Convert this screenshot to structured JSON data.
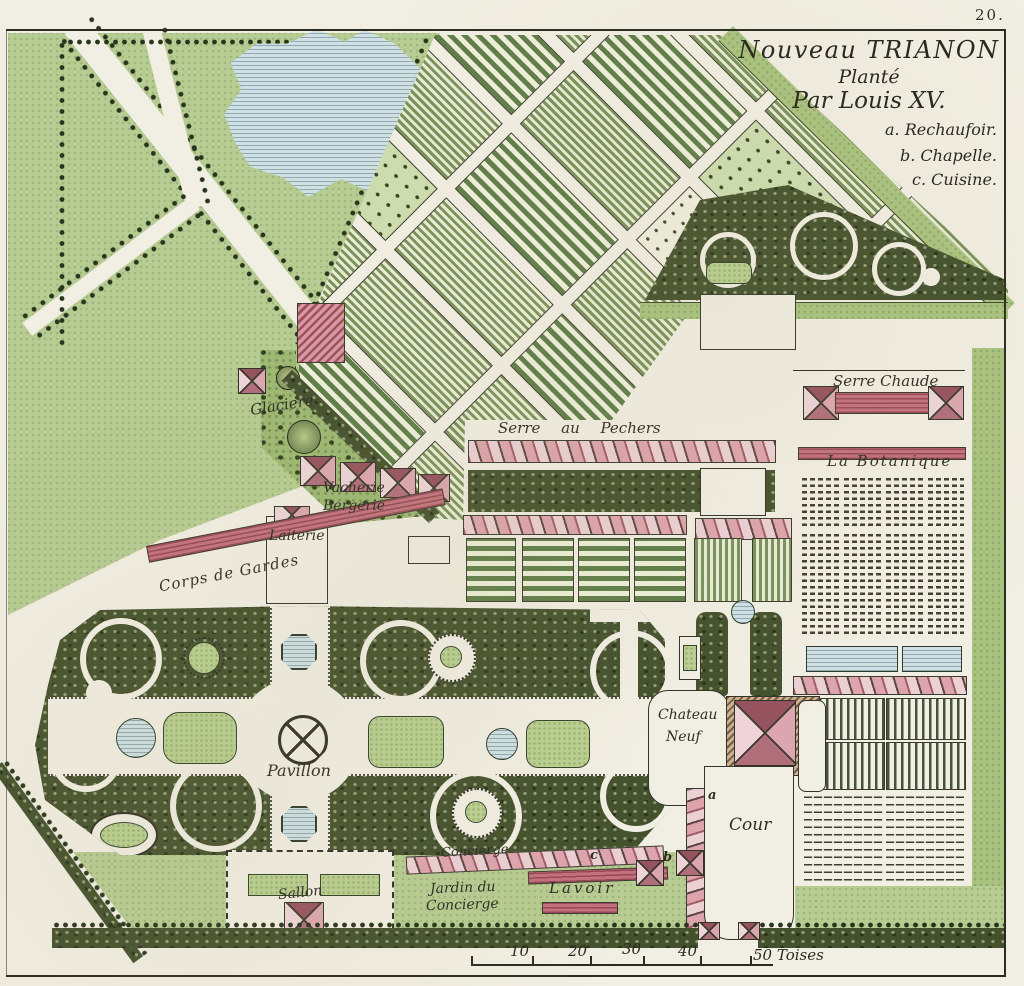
{
  "page": {
    "number": "20."
  },
  "title": {
    "line1": "Nouveau TRIANON",
    "line2": "Planté",
    "line3": "Par Louis XV."
  },
  "legend": {
    "items": [
      {
        "text": "a. Rechaufoir."
      },
      {
        "text": "b. Chapelle."
      },
      {
        "text": "c. Cuisine."
      }
    ]
  },
  "labels": {
    "glaciere": "Glaciere",
    "vacherie": "Vacherie",
    "bergerie": "Bergerie",
    "laiterie": "Laiterie",
    "corps_de_gardes": "Corps de Gardes",
    "serre_au_pechers": "Serre au Pechers",
    "serre_chaude": "Serre Chaude",
    "la_botanique": "La Botanique",
    "pavillon": "Pavillon",
    "chateau": "Chateau",
    "neuf": "Neuf",
    "cour": "Cour",
    "sallon": "Sallon",
    "concierge": "Concierge",
    "jardin_du": "Jardin du",
    "jardin_concierge": "Concierge",
    "lavoir": "Lavoir",
    "marker_a": "a",
    "marker_b": "b",
    "marker_c": "c"
  },
  "scale_bar": {
    "ticks": [
      "10",
      "20",
      "30",
      "40"
    ],
    "end_label": "50 Toises"
  },
  "colors": {
    "paper": "#f1eee3",
    "ink": "#2e2d24",
    "lawn": "#b7cc92",
    "bosquet": "#44512d",
    "water": "#cfe1e4",
    "building_pink": "#e3bdc4",
    "building_red": "#c2717e"
  }
}
